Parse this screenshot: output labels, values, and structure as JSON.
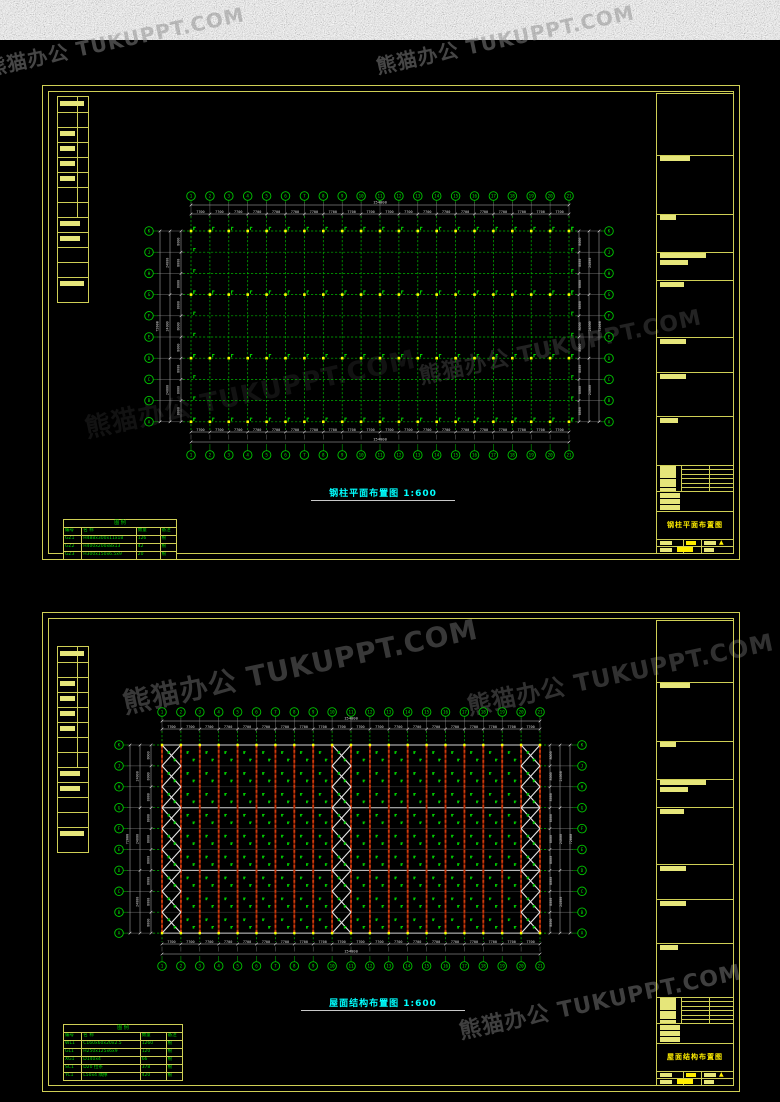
{
  "watermark": {
    "text": "熊猫办公 TUKUPPT.COM",
    "instances": [
      {
        "x": 115,
        "y": 40,
        "size": 20,
        "opacity": 0.5
      },
      {
        "x": 505,
        "y": 38,
        "size": 20,
        "opacity": 0.5
      },
      {
        "x": 250,
        "y": 392,
        "size": 26,
        "opacity": 0.13
      },
      {
        "x": 560,
        "y": 345,
        "size": 22,
        "opacity": 0.25
      },
      {
        "x": 300,
        "y": 665,
        "size": 28,
        "opacity": 0.4
      },
      {
        "x": 620,
        "y": 672,
        "size": 24,
        "opacity": 0.35
      },
      {
        "x": 600,
        "y": 1000,
        "size": 22,
        "opacity": 0.45
      }
    ]
  },
  "palette": {
    "frame_yellow": "#cfcf55",
    "bar_yellow": "#e6e67a",
    "marker_yellow": "#ffff00",
    "axis_green": "#00c800",
    "grid_green": "#00b400",
    "legend_green": "#00d800",
    "dim_white": "#d8d8d8",
    "title_cyan": "#00ffff",
    "purlin_red": "#7d1a02",
    "purlin_red_dash": "#cc3a0a",
    "brace_white": "#e6e6e6"
  },
  "sheet1": {
    "plan_title": "钢柱平面布置图 1:600",
    "titleblock_title": "钢柱平面布置图",
    "axes": {
      "cols": [
        "1",
        "2",
        "3",
        "4",
        "5",
        "6",
        "7",
        "8",
        "9",
        "10",
        "11",
        "12",
        "13",
        "14",
        "15",
        "16",
        "17",
        "18",
        "19",
        "20",
        "21"
      ],
      "rows": [
        "K",
        "J",
        "H",
        "G",
        "F",
        "E",
        "D",
        "C",
        "B",
        "A"
      ],
      "bay_dim": "7700",
      "bay_count": 20,
      "total_width": "154000",
      "row_dim": "8000",
      "row_count": 9,
      "row_group_dim": "24000",
      "total_height": "72000"
    },
    "legend": {
      "title": "图 例",
      "headers": [
        "编号",
        "名  称",
        "数量",
        "备注"
      ],
      "rows": [
        [
          "GZ1",
          "H488x300x11x18",
          "126",
          "根"
        ],
        [
          "GZ2",
          "H400x200x8x13",
          "42",
          "根"
        ],
        [
          "GZ3",
          "H300x150x6.5x9",
          "20",
          "根"
        ]
      ]
    }
  },
  "sheet2": {
    "plan_title": "屋面结构布置图 1:600",
    "titleblock_title": "屋面结构布置图",
    "axes": {
      "cols": [
        "1",
        "2",
        "3",
        "4",
        "5",
        "6",
        "7",
        "8",
        "9",
        "10",
        "11",
        "12",
        "13",
        "14",
        "15",
        "16",
        "17",
        "18",
        "19",
        "20",
        "21"
      ],
      "rows": [
        "K",
        "J",
        "H",
        "G",
        "F",
        "E",
        "D",
        "C",
        "B",
        "A"
      ],
      "bay_dim": "7700",
      "bay_count": 20,
      "total_width": "154000",
      "row_dim": "8000",
      "row_count": 9,
      "row_group_dim": "24000",
      "total_height": "72000"
    },
    "legend": {
      "title": "图 例",
      "headers": [
        "编号",
        "名  称",
        "数量",
        "备注"
      ],
      "rows": [
        [
          "WL1",
          "C160x60x20x2.5",
          "1260",
          "根"
        ],
        [
          "GL1",
          "H250x125x6x9",
          "120",
          "根"
        ],
        [
          "XG1",
          "D140x4",
          "66",
          "根"
        ],
        [
          "SC1",
          "D20 拉条",
          "378",
          "根"
        ],
        [
          "YC1",
          "L50x4 隅撑",
          "420",
          "根"
        ]
      ]
    }
  }
}
